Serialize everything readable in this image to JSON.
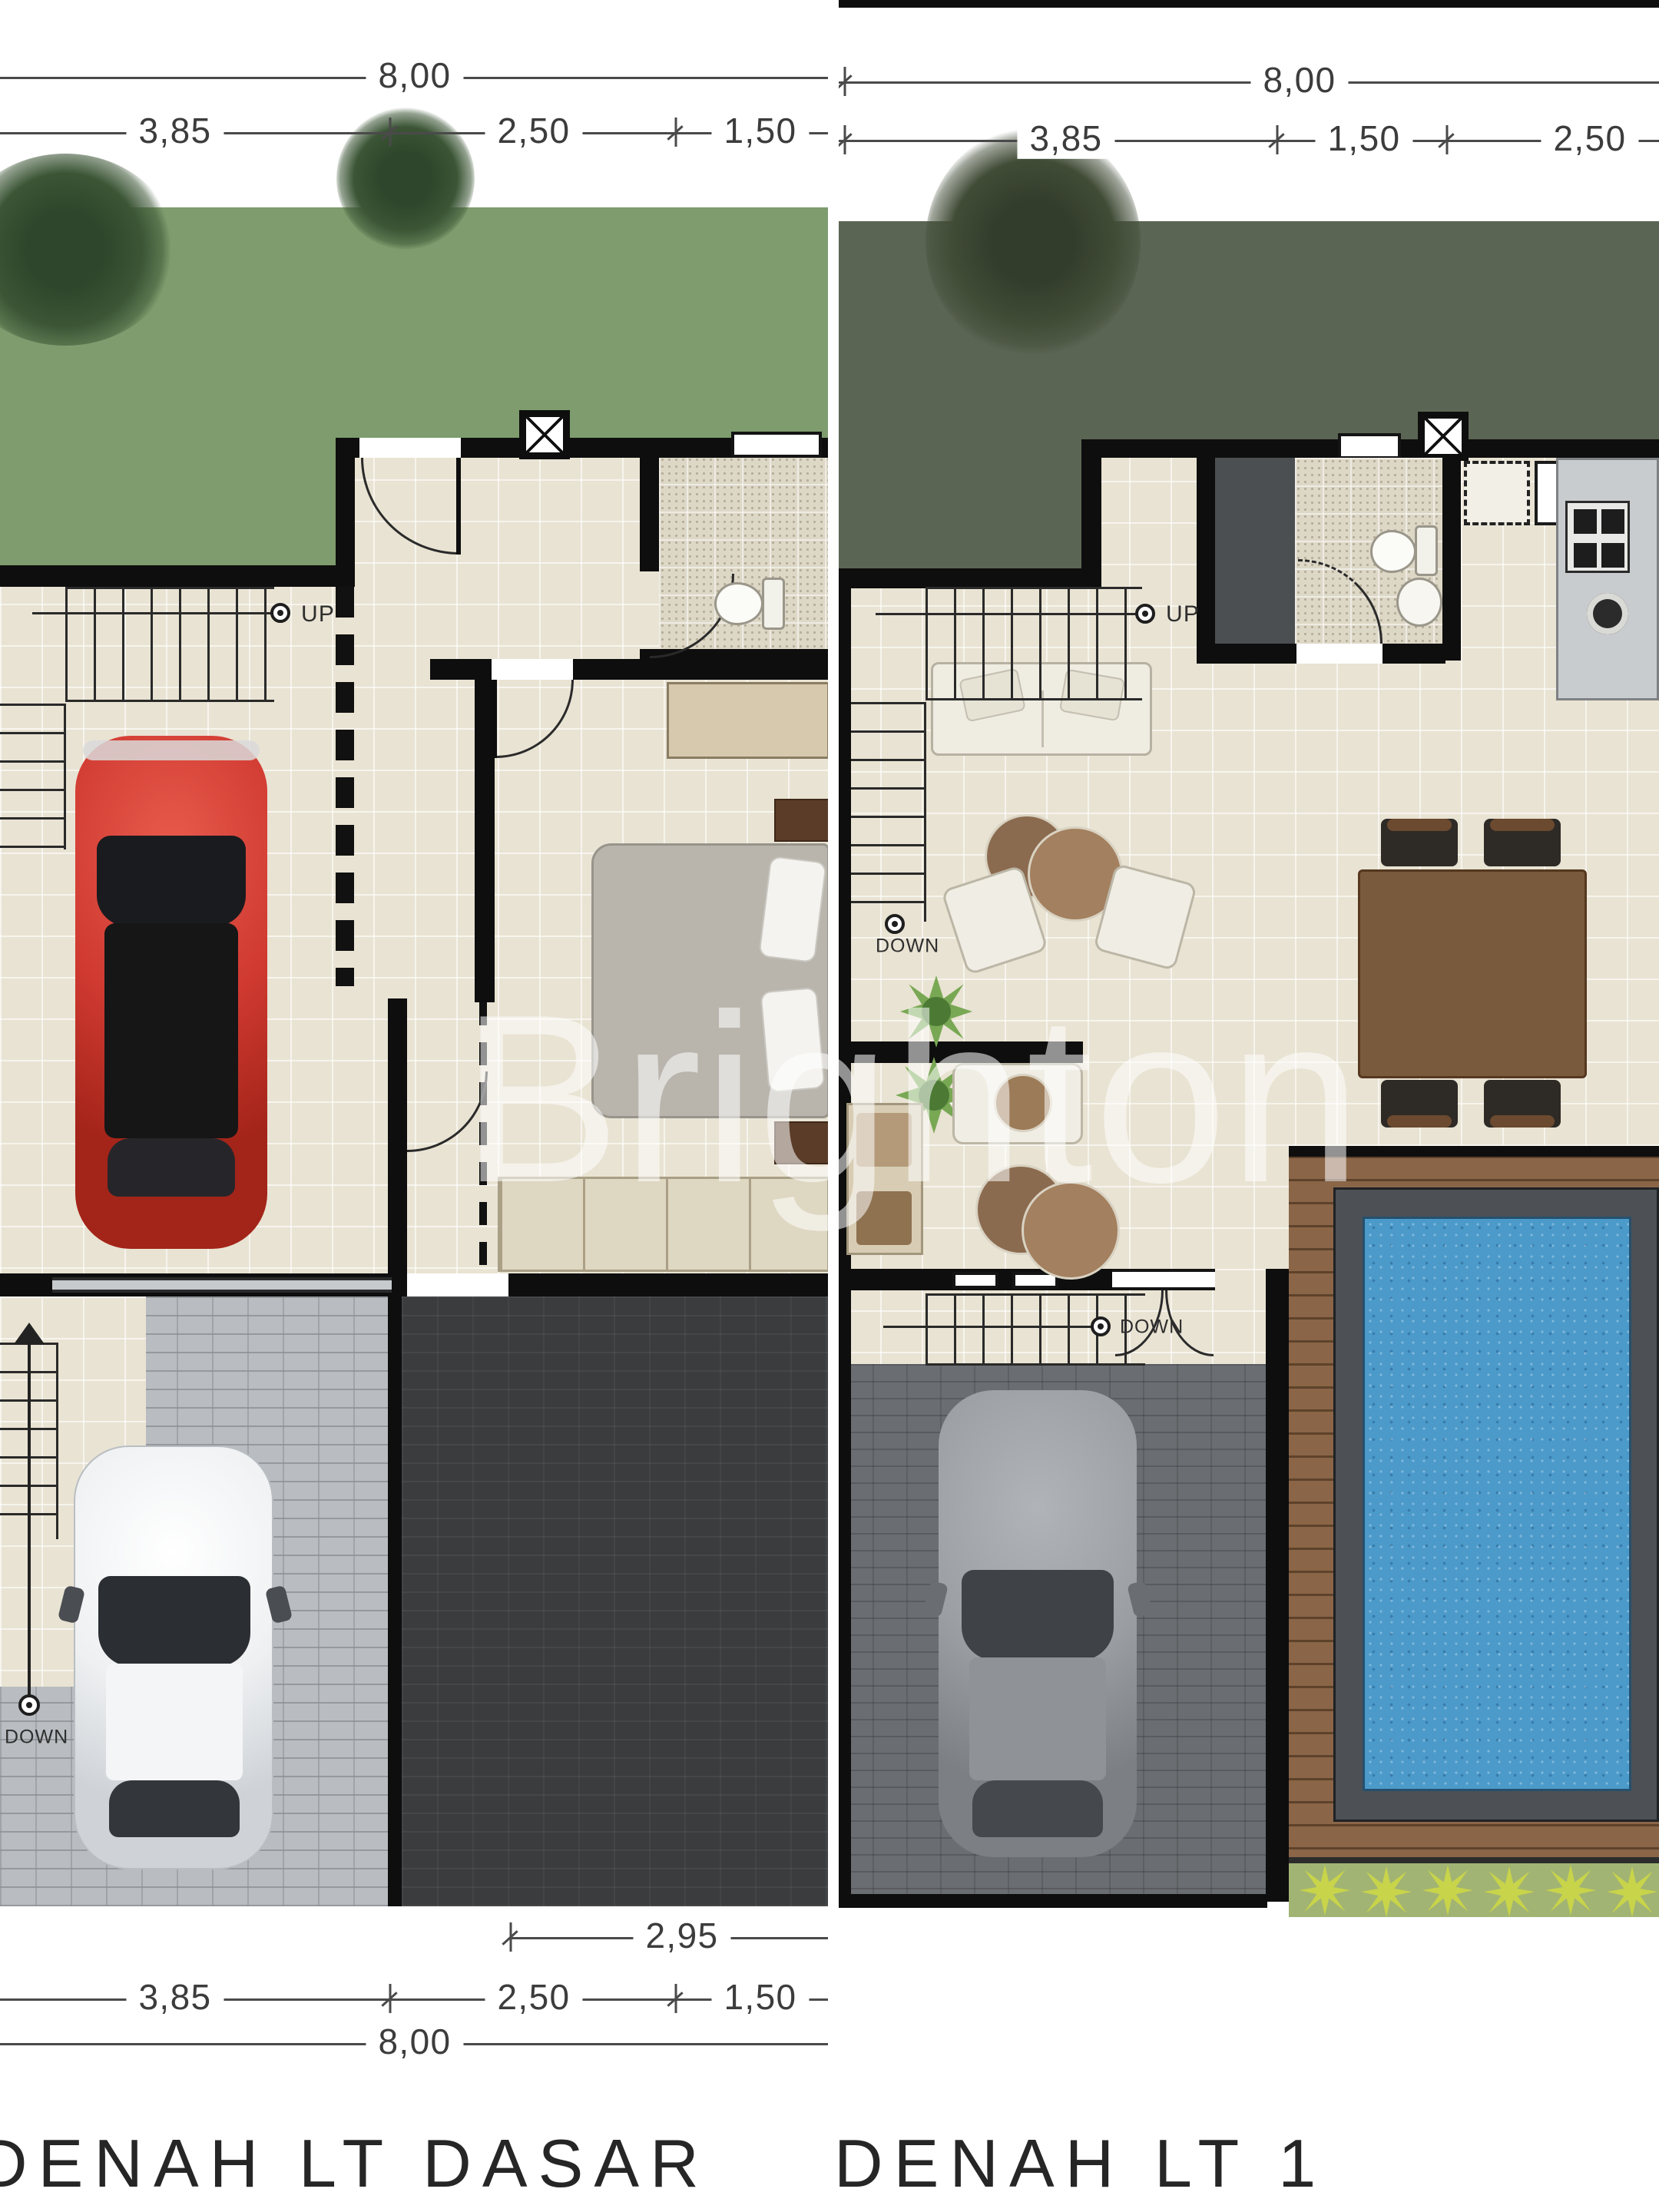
{
  "watermark": {
    "text": "Brighton"
  },
  "ground": {
    "title": "DENAH LT DASAR",
    "dim_top": {
      "total": "8,00",
      "seg1": "3,85",
      "seg2": "2,50",
      "seg3": "1,50"
    },
    "dim_bottom": {
      "inset": "2,95",
      "seg1": "3,85",
      "seg2": "2,50",
      "seg3": "1,50",
      "total": "8,00"
    },
    "labels": {
      "up": "UP",
      "down": "DOWN"
    }
  },
  "upper": {
    "title": "DENAH LT 1",
    "dim_top": {
      "total": "8,00",
      "seg1": "3,85",
      "seg2": "1,50",
      "seg3": "2,50"
    },
    "labels": {
      "up": "UP",
      "down_mid": "DOWN",
      "down_low": "DOWN"
    }
  },
  "colors": {
    "lawn_ground": "#7e9c6d",
    "lawn_upper": "#5b6553",
    "floor_tile": "#e9e3d3",
    "bath_tile": "#ddd7c6",
    "wall": "#0e0e0e",
    "driveway_paver": "#b9bdc1",
    "dark_lot": "#3a3c3e",
    "carport": "#6a6d71",
    "deck_wood": "#8a6547",
    "pool_water": "#4b9aca",
    "pool_coping": "#4d5156",
    "planter": "#a2b473",
    "car_red": "#cf3930",
    "car_white": "#eef0f2",
    "car_gray": "#9b9ea3",
    "watermark_color": "rgba(255,255,255,0.55)"
  },
  "icons": {
    "stair_direction": "stair-direction-icon",
    "shaft": "vent-shaft-symbol"
  }
}
